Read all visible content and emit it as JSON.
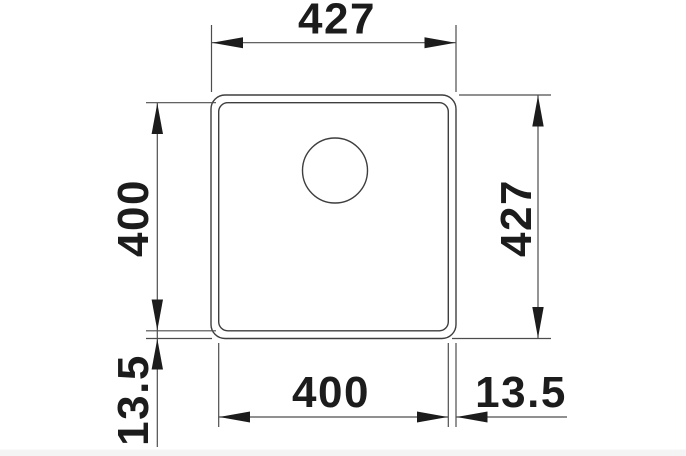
{
  "page": {
    "background": "#ffffff",
    "bottom_band_color": "#f4f4f5"
  },
  "drawing": {
    "type": "technical-drawing",
    "subject": "square undermount sink, top view with drain hole",
    "colors": {
      "edge": "#3e3e3e",
      "dimension_line": "#4d4d4d",
      "label": "#1c1c1c"
    },
    "dimensions": {
      "top_overall_width": "427",
      "right_overall_height": "427",
      "left_bowl_height": "400",
      "left_rim_offset": "13.5",
      "bottom_bowl_width": "400",
      "bottom_rim_offset": "13.5"
    }
  }
}
